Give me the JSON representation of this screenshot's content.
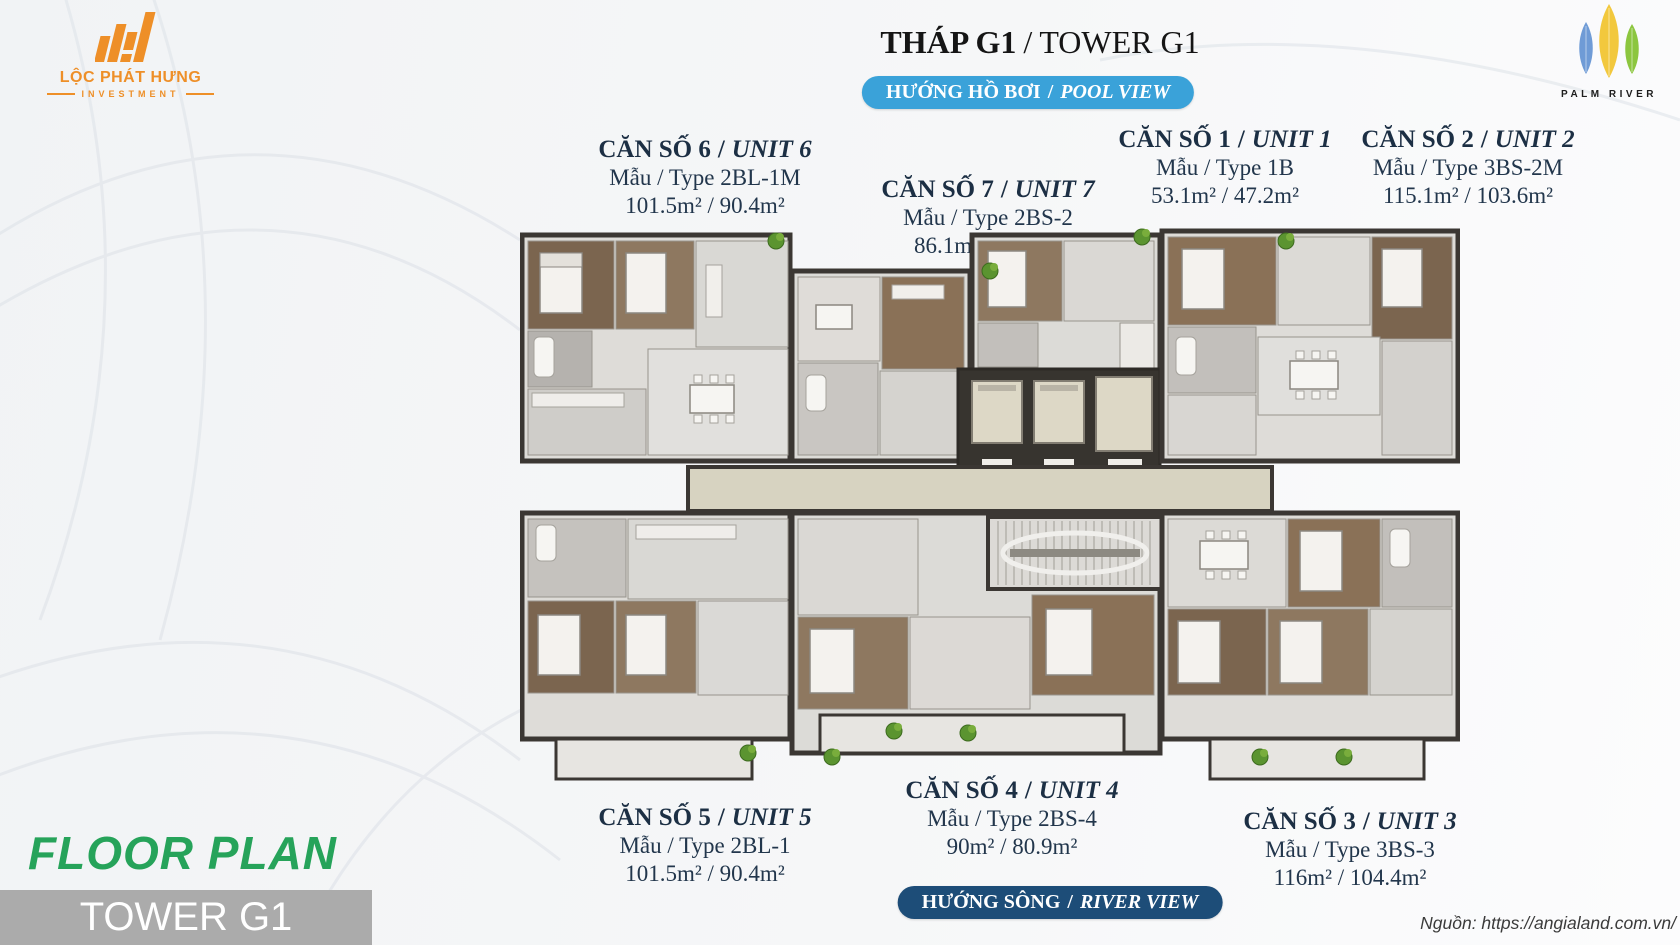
{
  "logos": {
    "loc_phat_hung": {
      "name": "LỘC PHÁT HƯNG",
      "subtitle": "INVESTMENT"
    },
    "palm_river": {
      "name": "PALM RIVER"
    }
  },
  "header": {
    "title_vi": "THÁP G1",
    "title_en": "TOWER G1"
  },
  "banners": {
    "pool": {
      "vi": "HƯỚNG HỒ BƠI",
      "en": "POOL VIEW"
    },
    "river": {
      "vi": "HƯỚNG SÔNG",
      "en": "RIVER VIEW"
    }
  },
  "units": [
    {
      "label_vi": "CĂN SỐ 6",
      "label_en": "UNIT 6",
      "type": "Mẫu / Type 2BL-1M",
      "area": "101.5m² / 90.4m²",
      "position": "top-left"
    },
    {
      "label_vi": "CĂN SỐ 7",
      "label_en": "UNIT 7",
      "type": "Mẫu / Type 2BS-2",
      "area": "86.1m² / 77.7m²",
      "position": "top-center"
    },
    {
      "label_vi": "CĂN SỐ 1",
      "label_en": "UNIT 1",
      "type": "Mẫu / Type 1B",
      "area": "53.1m² / 47.2m²",
      "position": "top-right-center"
    },
    {
      "label_vi": "CĂN SỐ 2",
      "label_en": "UNIT 2",
      "type": "Mẫu / Type 3BS-2M",
      "area": "115.1m² / 103.6m²",
      "position": "top-right"
    },
    {
      "label_vi": "CĂN SỐ 5",
      "label_en": "UNIT 5",
      "type": "Mẫu / Type 2BL-1",
      "area": "101.5m² / 90.4m²",
      "position": "bottom-left"
    },
    {
      "label_vi": "CĂN SỐ 4",
      "label_en": "UNIT 4",
      "type": "Mẫu / Type 2BS-4",
      "area": "90m² / 80.9m²",
      "position": "bottom-center"
    },
    {
      "label_vi": "CĂN SỐ 3",
      "label_en": "UNIT 3",
      "type": "Mẫu / Type 3BS-3",
      "area": "116m² / 104.4m²",
      "position": "bottom-right"
    }
  ],
  "footer": {
    "floor_plan_title": "FLOOR PLAN",
    "tower_label": "TOWER G1",
    "source_credit": "Nguồn: https://angialand.com.vn/"
  },
  "misc": {
    "separator": "/"
  },
  "colors": {
    "accent_green": "#26a35a",
    "banner_blue": "#3aa2d9",
    "banner_navy": "#1d4d78",
    "logo_orange": "#ee8f28",
    "text_navy": "#1c2f44",
    "tower_bar_gray": "#ababab",
    "corridor_beige": "#d7d3c1",
    "wall_dark": "#3b3733",
    "wood_dark": "#7b654f",
    "wood_mid": "#8e7860",
    "plant_green": "#5b9430"
  }
}
